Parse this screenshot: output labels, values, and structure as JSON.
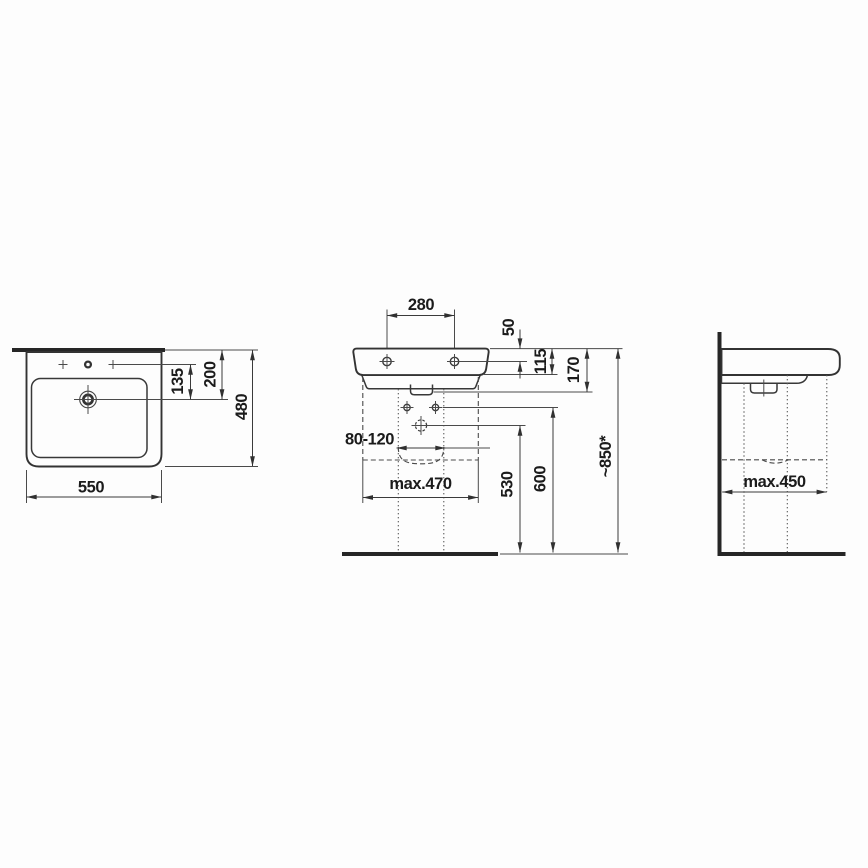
{
  "drawing": {
    "type": "washbasin-installation-technical-drawing",
    "unit": "mm",
    "colors": {
      "line": "#3b3b3b",
      "text": "#1b1b1b",
      "background": "#fdfdfd"
    }
  },
  "top_view": {
    "labels": {
      "width": "550",
      "depth": "480",
      "faucet_to_drain": "135",
      "rear_to_drain": "200"
    }
  },
  "front_view": {
    "labels": {
      "fixing_hole_spacing": "280",
      "rim_to_fixing_holes": "50",
      "rim_to_underside": "115",
      "body_height": "170",
      "drain_offset_range": "80-120",
      "max_clearance_width": "max.470",
      "drain_outlet_height": "530",
      "supply_height": "600",
      "rim_height_above_floor": "~850*"
    }
  },
  "side_view": {
    "labels": {
      "max_clearance_depth": "max.450"
    }
  }
}
